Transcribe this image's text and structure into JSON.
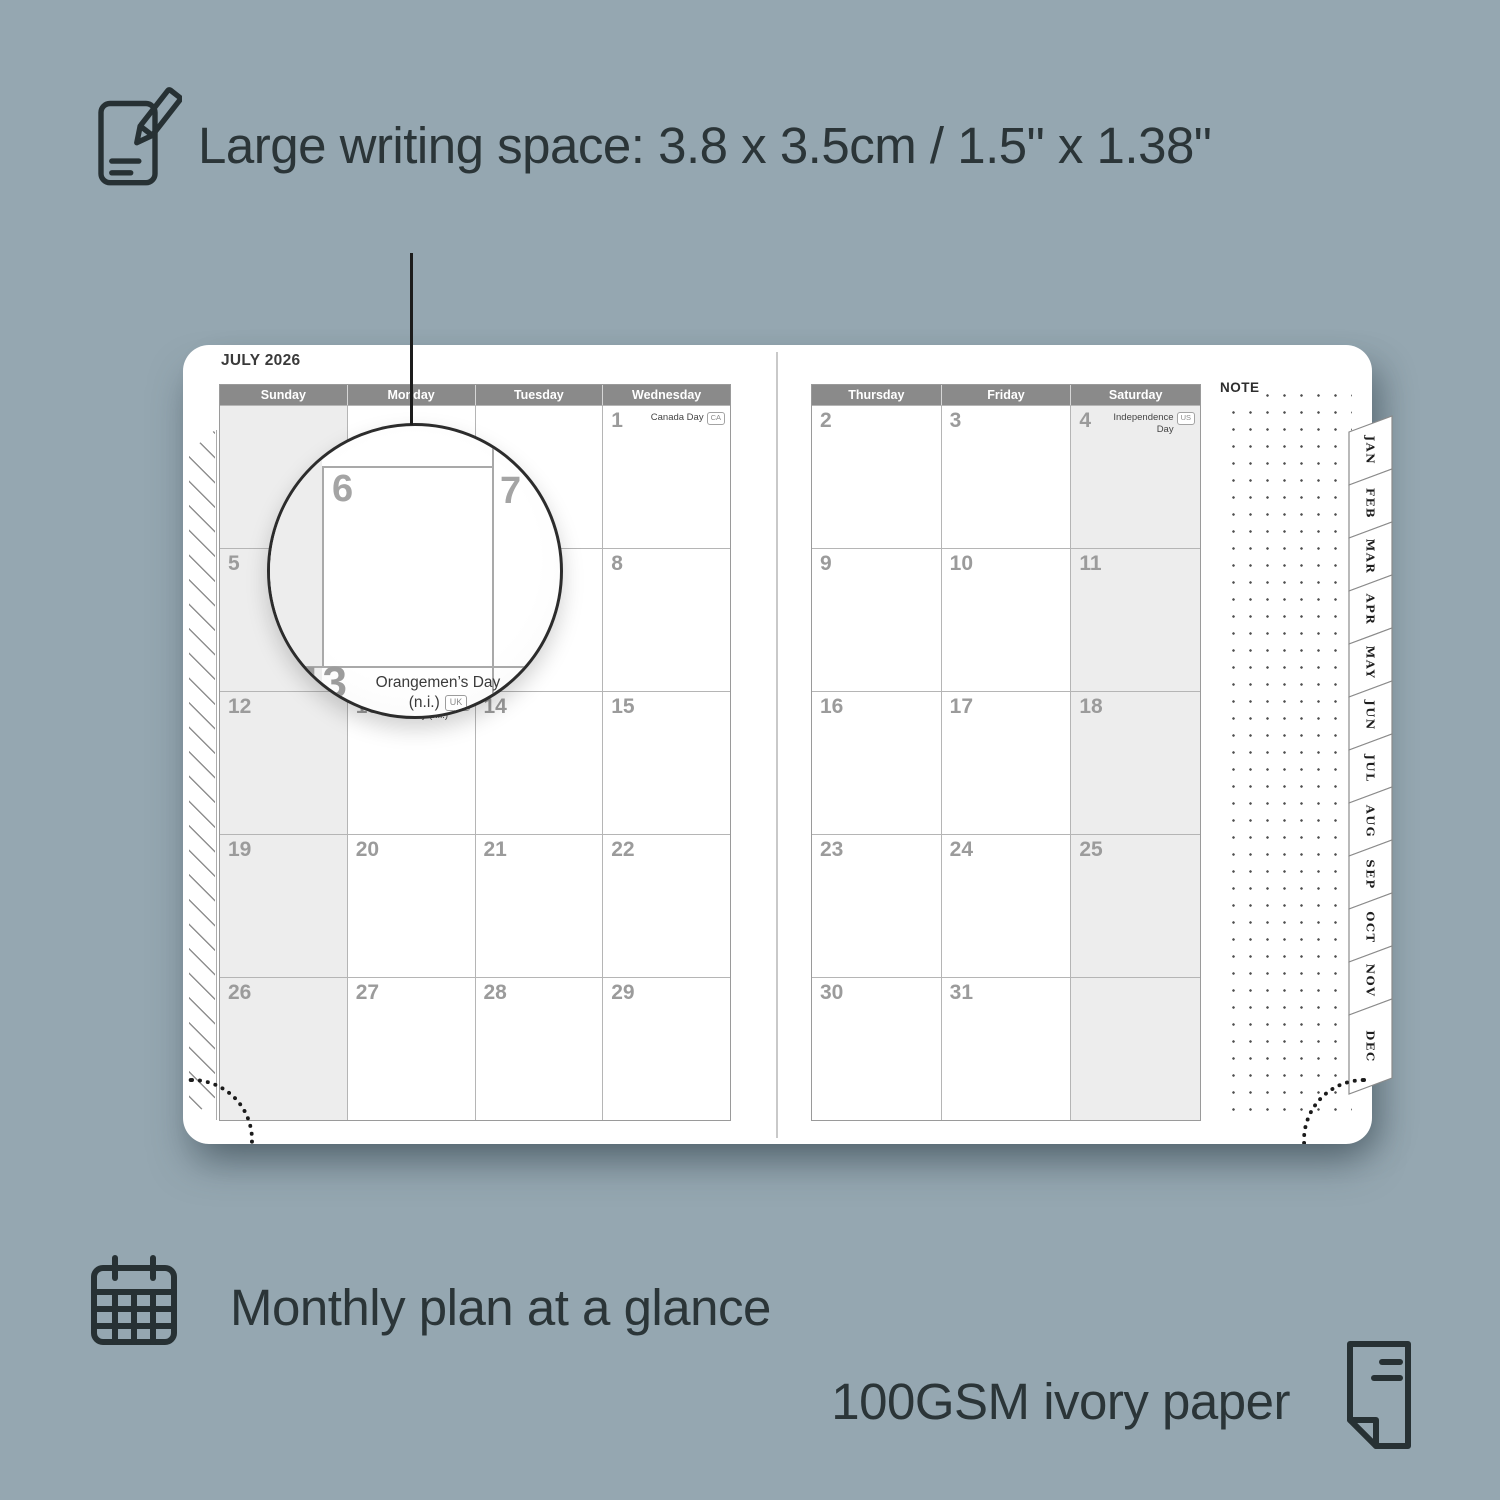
{
  "colors": {
    "background": "#95a7b1",
    "page": "#ffffff",
    "day_header_gray": "#8a8a8a",
    "weekend_shade": "#ededed",
    "annotation_text": "#2b3538"
  },
  "features": {
    "writing_space": {
      "icon": "notepad-pencil-icon",
      "label": "Large writing space: 3.8 x 3.5cm / 1.5\" x 1.38\""
    },
    "monthly_plan": {
      "icon": "calendar-grid-icon",
      "label": "Monthly plan at a glance"
    },
    "paper": {
      "icon": "paper-sheet-icon",
      "label": "100GSM ivory paper"
    }
  },
  "planner": {
    "month_title": "JULY 2026",
    "note_label": "NOTE",
    "left_page": {
      "day_headers": [
        "Sunday",
        "Monday",
        "Tuesday",
        "Wednesday"
      ],
      "shaded_column": "Sunday",
      "weeks": [
        [
          {
            "day": ""
          },
          {
            "day": ""
          },
          {
            "day": ""
          },
          {
            "day": "1",
            "holiday": "Canada Day",
            "badge": "CA"
          }
        ],
        [
          {
            "day": "5"
          },
          {
            "day": "6"
          },
          {
            "day": "7"
          },
          {
            "day": "8"
          }
        ],
        [
          {
            "day": "12"
          },
          {
            "day": "13",
            "holiday": "Orangemen’s Day (n.i.)",
            "badge": "UK"
          },
          {
            "day": "14"
          },
          {
            "day": "15"
          }
        ],
        [
          {
            "day": "19"
          },
          {
            "day": "20"
          },
          {
            "day": "21"
          },
          {
            "day": "22"
          }
        ],
        [
          {
            "day": "26"
          },
          {
            "day": "27"
          },
          {
            "day": "28"
          },
          {
            "day": "29"
          }
        ]
      ]
    },
    "right_page": {
      "day_headers": [
        "Thursday",
        "Friday",
        "Saturday"
      ],
      "shaded_column": "Saturday",
      "weeks": [
        [
          {
            "day": "2"
          },
          {
            "day": "3"
          },
          {
            "day": "4",
            "holiday": "Independence Day",
            "badge": "US"
          }
        ],
        [
          {
            "day": "9"
          },
          {
            "day": "10"
          },
          {
            "day": "11"
          }
        ],
        [
          {
            "day": "16"
          },
          {
            "day": "17"
          },
          {
            "day": "18"
          }
        ],
        [
          {
            "day": "23"
          },
          {
            "day": "24"
          },
          {
            "day": "25"
          }
        ],
        [
          {
            "day": "30"
          },
          {
            "day": "31"
          },
          {
            "day": ""
          }
        ]
      ]
    },
    "month_tabs": [
      "JAN",
      "FEB",
      "MAR",
      "APR",
      "MAY",
      "JUN",
      "JUL",
      "AUG",
      "SEP",
      "OCT",
      "NOV",
      "DEC"
    ],
    "magnifier": {
      "day": "6",
      "adjacent_day": "7",
      "next_week_day": "13",
      "holiday_name": "Orangemen’s Day",
      "holiday_detail": "(n.i.)",
      "holiday_badge": "UK"
    }
  }
}
